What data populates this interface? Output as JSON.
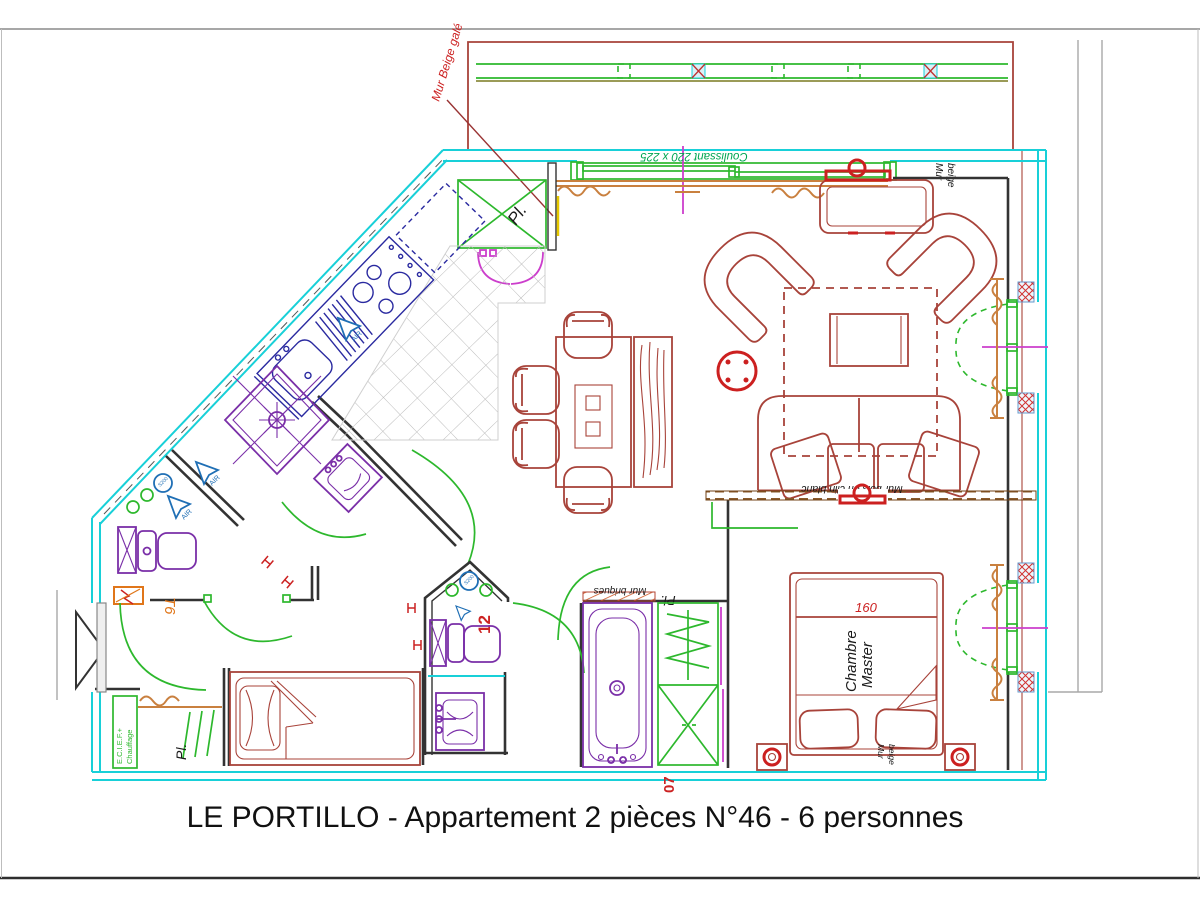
{
  "title": "LE PORTILLO - Appartement 2 pièces N°46 - 6 personnes",
  "labels": {
    "mur_beige_gale": "Mur Beige galé",
    "coulissant": "Coulissant 220 x 225",
    "mur": "Mur",
    "beige": "beige",
    "mur_bois": "Mur bois en clin blanc",
    "mur_briques": "Mur briques",
    "chambre": "Chambre",
    "master": "Master",
    "bed_width": "160",
    "t6": "T6",
    "ecief": "E.C.I.E.F.+",
    "chauffage": "Chauffage",
    "placard": "Pl.",
    "num07": "07",
    "num12": "12",
    "s200": "S200",
    "air": "AIR"
  },
  "colors": {
    "wall_exterior": "#18d0d8",
    "wall_interior": "#333333",
    "furniture": "#a8433a",
    "furniture_bold": "#cc2020",
    "fixtures_purple": "#7a2fa8",
    "doors_windows_green": "#2db82d",
    "sliding_label_green": "#00a550",
    "curtains_orange": "#c9803f",
    "kitchen_units_navy": "#2a2aa0",
    "vent_blue": "#1f6fb5",
    "bifold_magenta": "#cc3ecc",
    "accent_orange": "#e0761a",
    "annotation_red": "#cc2222",
    "wood_brown": "#8a5a2b"
  }
}
